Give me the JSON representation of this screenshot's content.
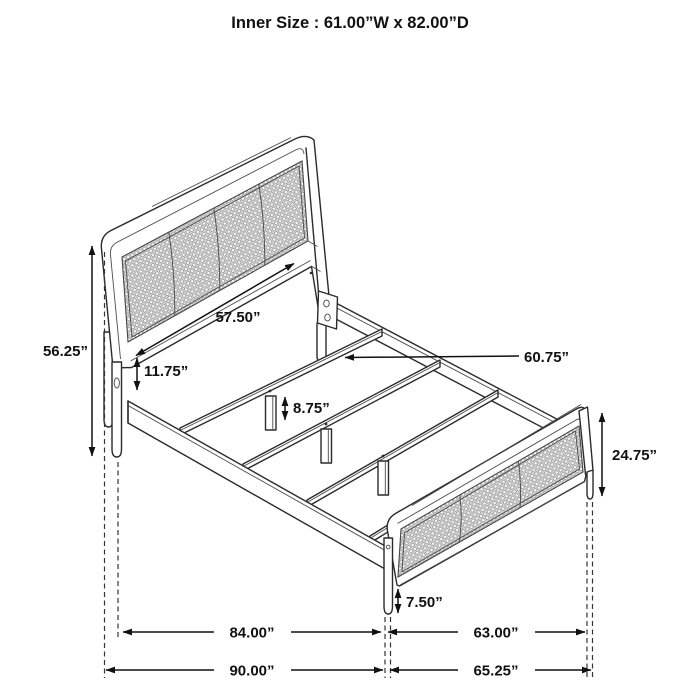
{
  "title": "Inner Size : 61.00”W x 82.00”D",
  "product": "bed frame assembly dimension diagram",
  "dims": {
    "headboard_height": "56.25”",
    "headboard_width": "57.50”",
    "deck_height": "11.75”",
    "slat_leg_height": "8.75”",
    "slat_length": "60.75”",
    "footboard_height": "24.75”",
    "footboard_leg_height": "7.50”",
    "length_inner": "84.00”",
    "width_footboard": "63.00”",
    "length_overall": "90.00”",
    "width_overall": "65.25”"
  },
  "colors": {
    "background": "#ffffff",
    "line_art": "#2b2b2b",
    "dimension": "#111111",
    "mesh_fill": "#e4e4e4"
  }
}
